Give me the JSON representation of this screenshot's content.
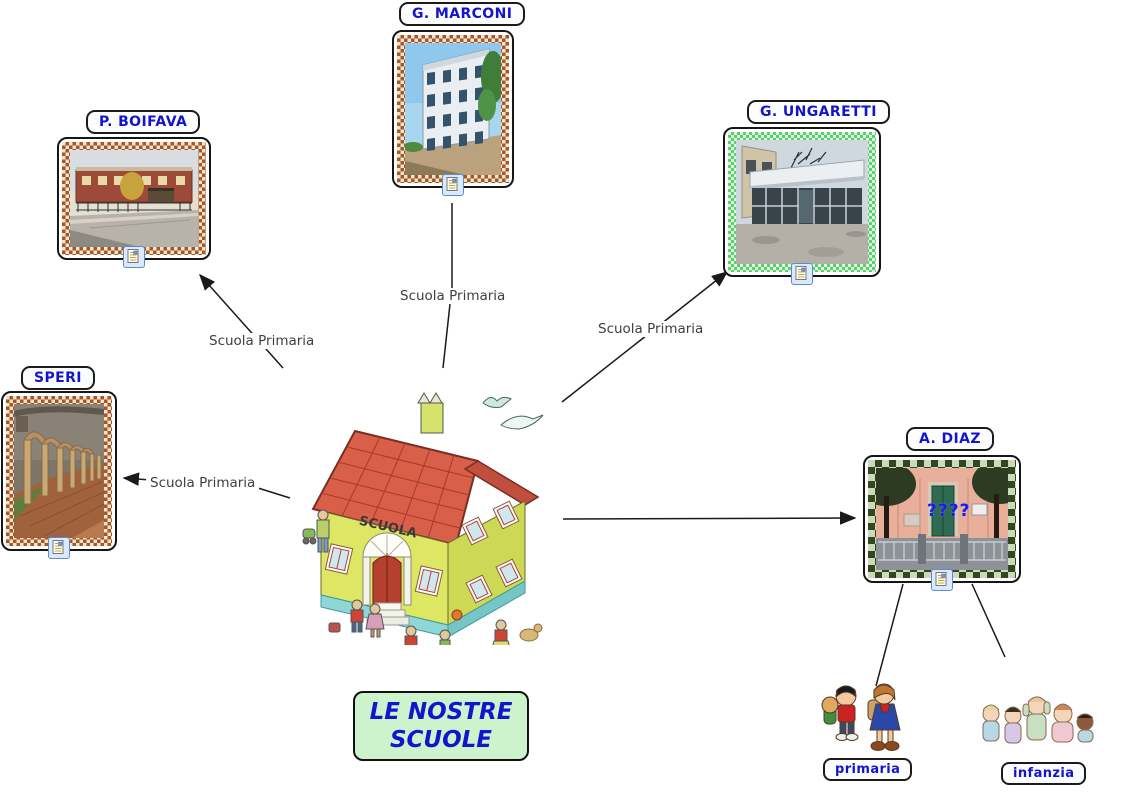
{
  "map_title": {
    "line1": "LE NOSTRE",
    "line2": "SCUOLE"
  },
  "central_node": {
    "sign": "SCUOLA",
    "image": "cartoon-school-building-with-children"
  },
  "schools": {
    "marconi": {
      "label": "G. MARCONI",
      "photo": "four-story-school-building",
      "frame": "brown-checkered"
    },
    "boifava": {
      "label": "P. BOIFAVA",
      "photo": "brick-school-with-street",
      "frame": "brown-checkered"
    },
    "ungaretti": {
      "label": "G. UNGARETTI",
      "photo": "glass-entrance-school",
      "frame": "green-checkered"
    },
    "speri": {
      "label": "SPERI",
      "photo": "cloister-with-columns",
      "frame": "brown-checkered"
    },
    "diaz": {
      "label": "A. DIAZ",
      "photo": "school-entrance-with-trees",
      "frame": "dark-green-checkered",
      "overlay": "????"
    }
  },
  "links": {
    "to_marconi": {
      "label": "Scuola Primaria"
    },
    "to_boifava": {
      "label": "Scuola Primaria"
    },
    "to_ungaretti": {
      "label": "Scuola Primaria"
    },
    "to_speri": {
      "label": "Scuola Primaria"
    }
  },
  "categories": {
    "primaria": {
      "label": "primaria",
      "image": "two-children-with-backpacks"
    },
    "infanzia": {
      "label": "infanzia",
      "image": "group-of-toddlers"
    }
  },
  "icons": {
    "resource_icon": "document-with-image"
  },
  "colors": {
    "node_text": "#1414cc",
    "node_bg": "#fbfdff",
    "title_bg": "#ccf3cc",
    "link_text": "#3f3f3f",
    "line": "#1a1a1a",
    "frame_brown": "#a3582b",
    "frame_green": "#5ecf6e",
    "frame_dark_green": "#33471f"
  }
}
